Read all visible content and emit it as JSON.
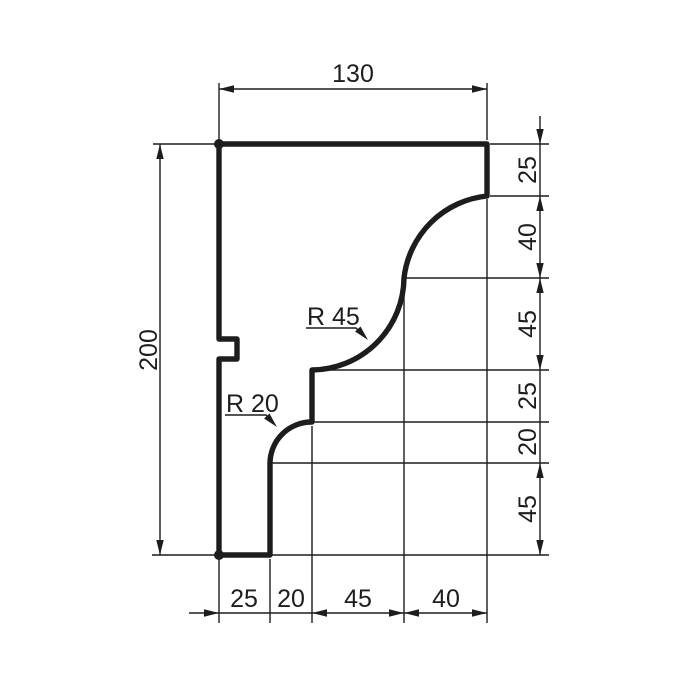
{
  "drawing": {
    "type": "technical-profile-drawing",
    "colors": {
      "line": "#1d1d1d",
      "background": "#ffffff"
    },
    "dimensions": {
      "top": "130",
      "left": "200",
      "right": [
        "25",
        "40",
        "45",
        "25",
        "20",
        "45"
      ],
      "bottom": [
        "25",
        "20",
        "45",
        "40"
      ]
    },
    "radius_labels": [
      "R 45",
      "R 20"
    ]
  }
}
